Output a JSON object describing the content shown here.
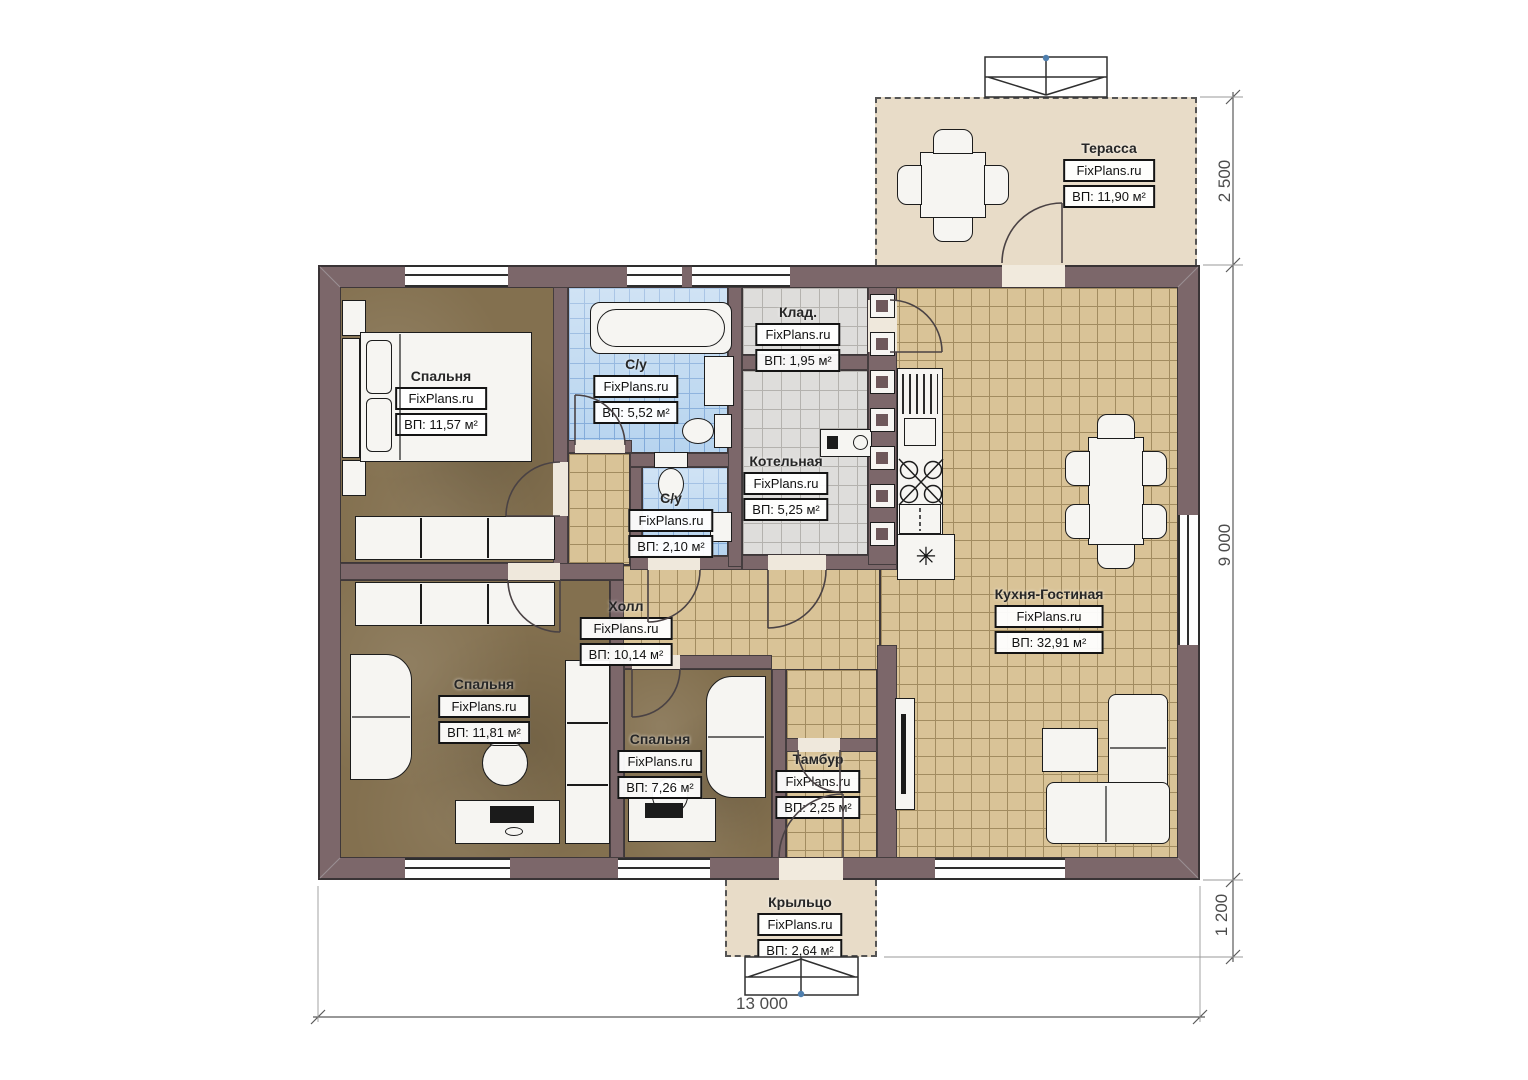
{
  "brand": "FixPlans.ru",
  "rooms": [
    {
      "key": "terrace",
      "name": "Терасса",
      "area": "ВП: 11,90 м²"
    },
    {
      "key": "bedroom-tl",
      "name": "Спальня",
      "area": "ВП: 11,57 м²"
    },
    {
      "key": "bath-main",
      "name": "С/у",
      "area": "ВП: 5,52 м²"
    },
    {
      "key": "storage",
      "name": "Клад.",
      "area": "ВП: 1,95 м²"
    },
    {
      "key": "boiler",
      "name": "Котельная",
      "area": "ВП: 5,25 м²"
    },
    {
      "key": "bath-small",
      "name": "С/у",
      "area": "ВП: 2,10 м²"
    },
    {
      "key": "hall",
      "name": "Холл",
      "area": "ВП: 10,14 м²"
    },
    {
      "key": "kitchen",
      "name": "Кухня-Гостиная",
      "area": "ВП: 32,91 м²"
    },
    {
      "key": "bedroom-bl",
      "name": "Спальня",
      "area": "ВП: 11,81 м²"
    },
    {
      "key": "bedroom-bm",
      "name": "Спальня",
      "area": "ВП: 7,26 м²"
    },
    {
      "key": "tambour",
      "name": "Тамбур",
      "area": "ВП: 2,25 м²"
    },
    {
      "key": "porch",
      "name": "Крыльцо",
      "area": "ВП: 2,64 м²"
    }
  ],
  "dimensions": {
    "terrace_depth": "2 500",
    "house_depth": "9 000",
    "porch_depth": "1 200",
    "house_width": "13 000"
  },
  "icons": {
    "sink_drain": "✳"
  },
  "colors": {
    "wall": "#7c676a",
    "floor_wood": "#83704f",
    "tile_beige": "#d9c397",
    "tile_blue": "#b7d4ef",
    "tile_gray": "#dedddb",
    "outdoor": "#e8dcc8"
  }
}
